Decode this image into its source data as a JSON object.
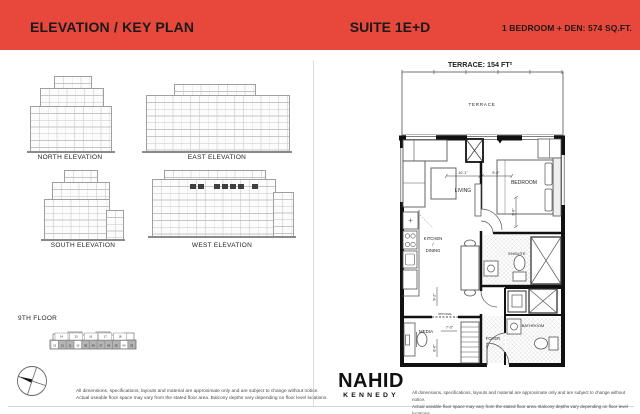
{
  "colors": {
    "header_bg": "#E8473C",
    "wall": "#111111",
    "keyplan_shaded": "#b4b4b4"
  },
  "header": {
    "title": "ELEVATION / KEY PLAN",
    "suite": "SUITE 1E+D",
    "unit_info": "1 BEDROOM + DEN:  574 SQ.FT."
  },
  "elevations": {
    "north": "NORTH ELEVATION",
    "east": "EAST ELEVATION",
    "south": "SOUTH ELEVATION",
    "west": "WEST ELEVATION"
  },
  "key_plan": {
    "floor": "9TH FLOOR",
    "top_row": [
      "14",
      "15",
      "16",
      "17",
      "18"
    ],
    "bottom_row": [
      "13",
      "12",
      "11",
      "10",
      "09",
      "08",
      "07",
      "06",
      "05",
      "04",
      "03"
    ],
    "shaded_cells": [
      1,
      2,
      4,
      5,
      6,
      7,
      8,
      10
    ]
  },
  "floor_plan": {
    "terrace_title": "TERRACE: 154 FT²",
    "labels": {
      "terrace": "TERRACE",
      "living": "LIVING",
      "bedroom": "BEDROOM",
      "kitchen1": "KITCHEN",
      "kitchen2": "/",
      "kitchen3": "DINING",
      "ensuite": "ENSUITE",
      "bathroom": "BATHROOM",
      "media": "MEDIA",
      "foyer": "FOYER",
      "optional": "OPTIONAL"
    },
    "dims": {
      "living_w": "10'-1\"",
      "bedroom_w": "9'-0\"",
      "bedroom_d": "9'-6\"",
      "kitchen_d": "9'-2\"",
      "media_d": "8'-6\"",
      "media_w": "7'-3\""
    }
  },
  "footer": {
    "logo_top": "NAHID",
    "logo_bottom": "KENNEDY",
    "disclaimer1": "All dimensions, specifications, layouts and material are approximate only and are subject to change without notice.",
    "disclaimer2": "Actual useable floor space may vary from the stated floor area. Balcony depths vary depending on floor level locations."
  }
}
